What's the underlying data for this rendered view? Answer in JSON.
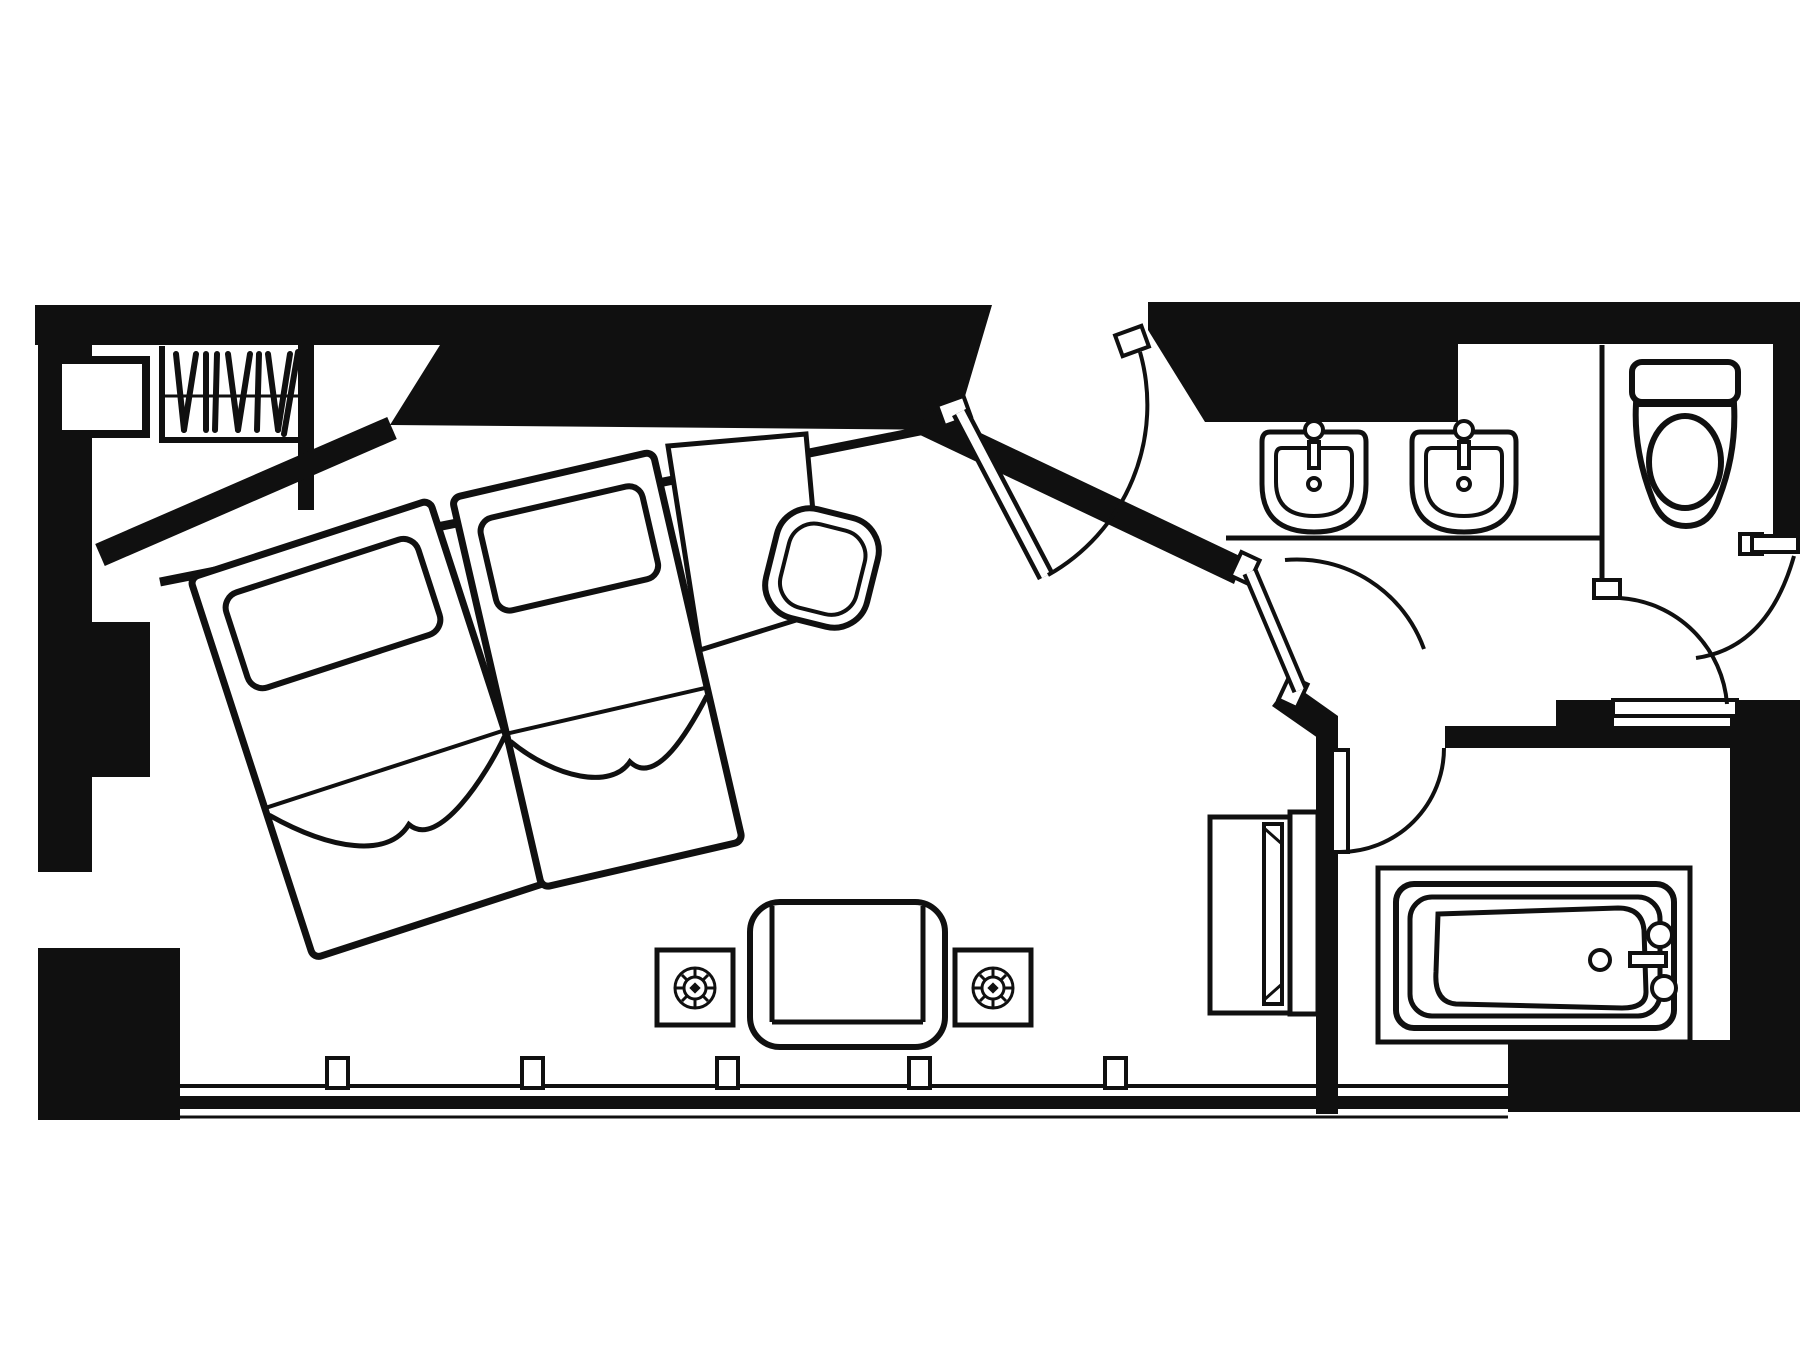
{
  "page": {
    "description": "Black-and-white architectural floor plan of a hotel twin room with entry hall, vanity with two sinks, separate toilet room and bathtub room",
    "aria_label": "Hotel twin room floor plan drawing"
  },
  "colors": {
    "ink": "#101010",
    "paper": "#ffffff"
  },
  "plan": {
    "style": "black and white line drawing, walls as solid black fills, furniture as outlined shapes",
    "rooms": [
      {
        "id": "bedroom",
        "furniture": [
          "twin-bed-1",
          "twin-bed-2",
          "pillow-1",
          "pillow-2",
          "headboard-panel",
          "wardrobe-with-hangers",
          "safe-shelf",
          "desk",
          "desk-chair",
          "sofa",
          "side-table-with-lamp-left",
          "side-table-with-lamp-right",
          "tv-cabinet",
          "television"
        ]
      },
      {
        "id": "vanity-area",
        "furniture": [
          "vanity-counter",
          "sink-left",
          "sink-right"
        ]
      },
      {
        "id": "toilet-room",
        "furniture": [
          "toilet"
        ]
      },
      {
        "id": "bathtub-room",
        "furniture": [
          "bathtub",
          "tub-faucet",
          "tub-drain"
        ]
      }
    ],
    "doors": [
      "entry-door",
      "vanity-door",
      "bathtub-room-door",
      "toilet-room-door",
      "right-closet-door"
    ],
    "window_wall": {
      "mullion_count": 5
    }
  }
}
